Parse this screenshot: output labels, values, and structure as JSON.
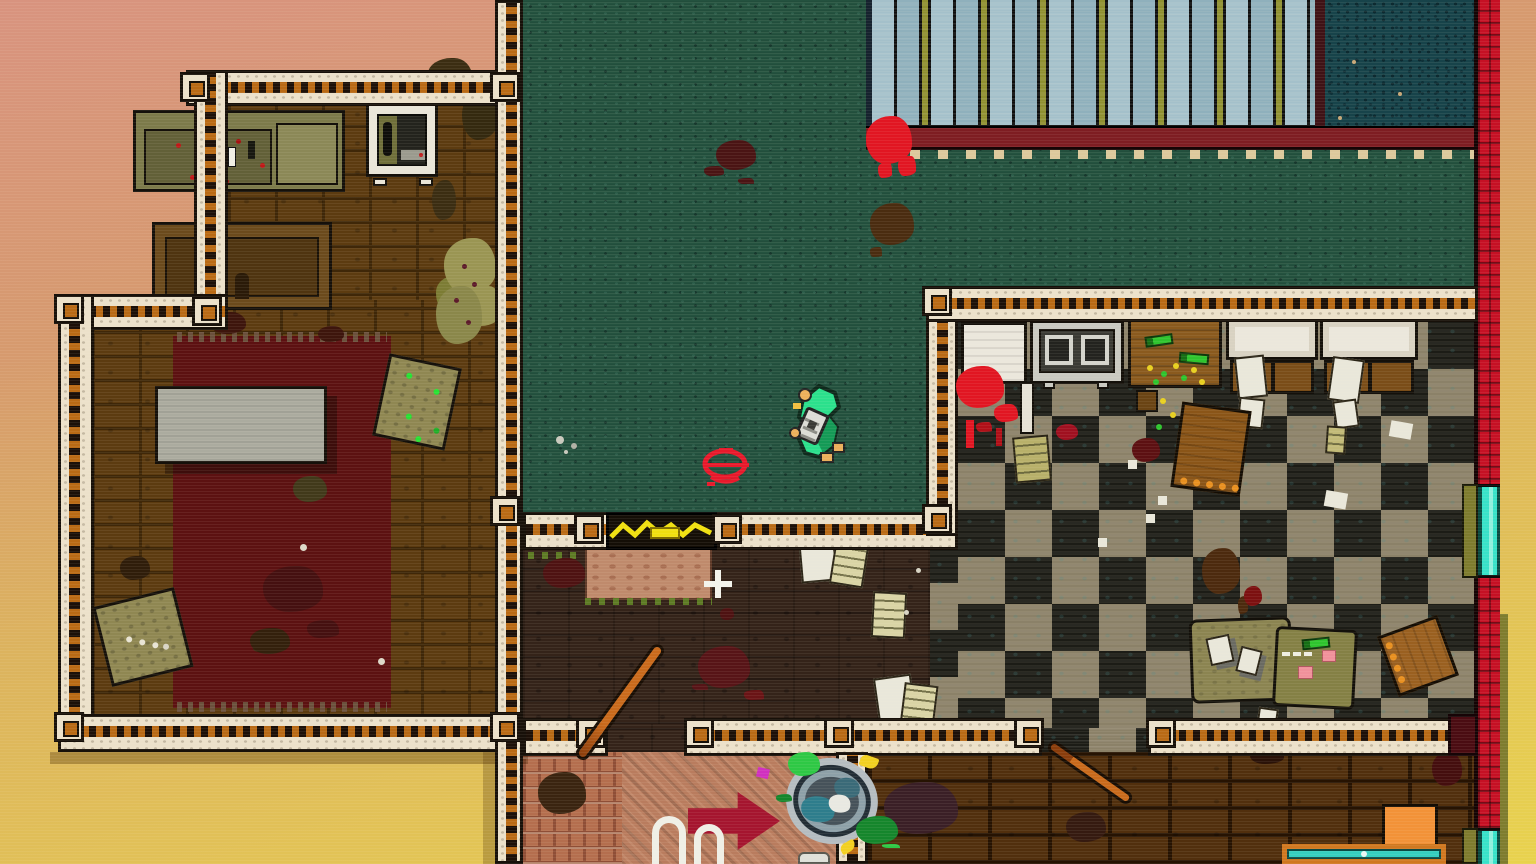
{
  "meta": {
    "scene": "top-down pixel-art apartment level",
    "hud_text": ""
  },
  "palette": {
    "outside-top": "#d8937f",
    "outside-mid": "#dcb35e",
    "outside-bottom": "#e8d24e",
    "wall-cream": "#ece1ca",
    "wall-trim-orange": "#b96a15",
    "wall-outline": "#171009",
    "bedroom-brick": "#5c3b10",
    "bedroom-mortar": "#3f2708",
    "carpet": "#24523f",
    "carpet-dot-light": "#2f5f4c",
    "carpet-dot-dark": "#17382d",
    "darkroom": "#342319",
    "kitchen-tan": "#8b8168",
    "kitchen-dark": "#1c1c16",
    "brickroom": "#512f0d",
    "brickroom-mortar": "#261302",
    "hall-tile": "#b46e4e",
    "hall-tile-gap": "#8f4e36",
    "hall-diag": "#b97c5e",
    "blinds-blue": "#a4c0ca",
    "blinds-blue2": "#8fb0bc",
    "blinds-yellow": "#8f9030",
    "pool": "#17434a",
    "navy-edge": "#16222e",
    "railing": "#7e1d22",
    "railing-post": "#dcc99c",
    "blood": "#e11622",
    "blood-dark": "#571417",
    "blood-brown": "#4c2c10",
    "east-red": "#c51024",
    "door-teal": "#38e2c9",
    "door-olive": "#7e7c2e",
    "rug": "#5c1111",
    "rug-fringe": "#6b503c",
    "mattress": "#abab9f",
    "couch": "#7c7a4a",
    "couch-seat": "#626038",
    "wood": "#8a5a1e",
    "paper": "#d9d4a5",
    "desk": "#8b8451",
    "table-orange": "#f29238",
    "teal-table": "#35cfc0",
    "arrow": "#a5152f",
    "bat": "#b25b16",
    "trash-green": "#2ec845",
    "player-green": "#2be08c",
    "skin": "#ecaf5b",
    "moss": "#5d7a24",
    "graffiti-red": "#e8192b"
  },
  "rooms": [
    {
      "name": "bedroom",
      "floor": "brown-brick"
    },
    {
      "name": "lounge",
      "floor": "green-carpet"
    },
    {
      "name": "balcony",
      "floor": "teal-with-blinds-and-railing"
    },
    {
      "name": "kitchen",
      "floor": "checkered-tile"
    },
    {
      "name": "store-room",
      "floor": "dark-wood"
    },
    {
      "name": "hallway",
      "floor": "red-tile-and-clay"
    },
    {
      "name": "back-room",
      "floor": "dark-brick"
    },
    {
      "name": "street-outside",
      "floor": "sunset-gradient"
    }
  ],
  "objects": [
    {
      "name": "fallen-figure",
      "color": "#2be08c"
    },
    {
      "name": "red-graffiti-splat",
      "color": "#e8192b"
    },
    {
      "name": "chain-locked-door",
      "color": "#f0e010"
    },
    {
      "name": "teal-exit-door-upper",
      "color": "#38e2c9"
    },
    {
      "name": "teal-exit-door-lower",
      "color": "#38e2c9"
    },
    {
      "name": "balcony-railing",
      "color": "#7e1d22"
    },
    {
      "name": "railing-blood-splat",
      "color": "#e11622"
    },
    {
      "name": "couch",
      "color": "#7c7a4a"
    },
    {
      "name": "tv-set",
      "color": "#23231d"
    },
    {
      "name": "dresser",
      "color": "#6b4a1c"
    },
    {
      "name": "red-rug",
      "color": "#5c1111"
    },
    {
      "name": "mattress",
      "color": "#abab9f"
    },
    {
      "name": "floor-cushion-1",
      "color": "#8f8752"
    },
    {
      "name": "floor-cushion-2",
      "color": "#8f8752"
    },
    {
      "name": "dried-plant",
      "color": "#9a9553"
    },
    {
      "name": "fridge-with-blood",
      "color": "#ebe7dc"
    },
    {
      "name": "stove",
      "color": "#c9c9c1"
    },
    {
      "name": "wood-counter-with-bottles",
      "color": "#8a5a1e"
    },
    {
      "name": "cabinet-1",
      "color": "#ebe7dc"
    },
    {
      "name": "cabinet-2",
      "color": "#ebe7dc"
    },
    {
      "name": "overturned-table",
      "color": "#8a5518"
    },
    {
      "name": "overturned-chair",
      "color": "#9a6020"
    },
    {
      "name": "office-desk-with-papers",
      "color": "#8b8451"
    },
    {
      "name": "baseball-bat-1",
      "color": "#b25b16"
    },
    {
      "name": "baseball-bat-2",
      "color": "#b25b16"
    },
    {
      "name": "trash-can-tipped",
      "color": "#aeb6ba"
    },
    {
      "name": "painted-floor-arrow",
      "color": "#a5152f"
    },
    {
      "name": "white-floor-graffiti",
      "color": "#efefe6"
    },
    {
      "name": "doormat",
      "color": "#bf8a6c"
    },
    {
      "name": "scattered-papers",
      "color": "#d9d4a5"
    },
    {
      "name": "orange-side-table",
      "color": "#f29238"
    },
    {
      "name": "teal-top-table",
      "color": "#35cfc0"
    }
  ]
}
